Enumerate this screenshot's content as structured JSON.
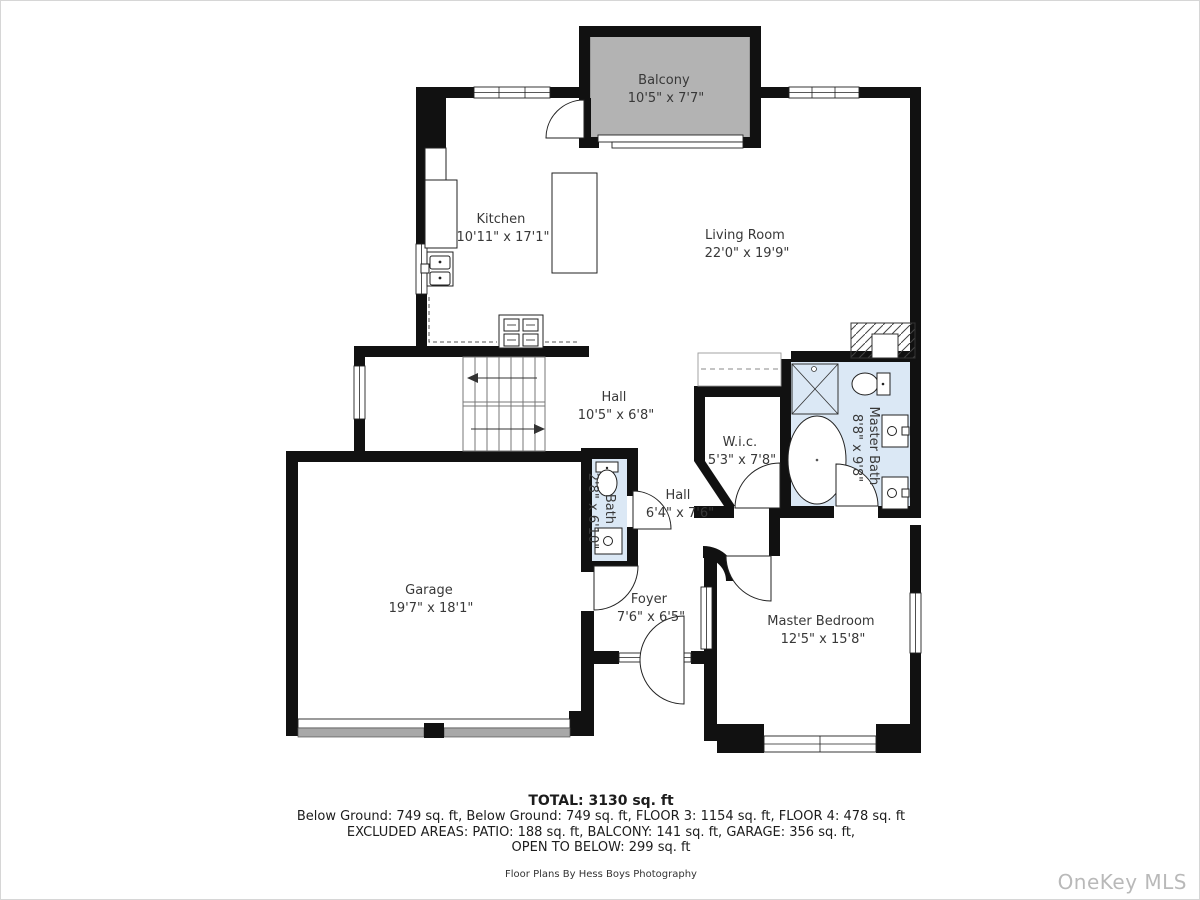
{
  "rooms": {
    "balcony": {
      "name": "Balcony",
      "dims": "10'5\" x 7'7\""
    },
    "kitchen": {
      "name": "Kitchen",
      "dims": "10'11\" x 17'1\""
    },
    "living_room": {
      "name": "Living Room",
      "dims": "22'0\" x 19'9\""
    },
    "hall_upper": {
      "name": "Hall",
      "dims": "10'5\" x 6'8\""
    },
    "wic": {
      "name": "W.i.c.",
      "dims": "5'3\" x 7'8\""
    },
    "master_bath": {
      "name": "Master Bath",
      "dims": "8'8\" x 9'8\""
    },
    "bath": {
      "name": "Bath",
      "dims": "2'8\" x 6'10\""
    },
    "hall_lower": {
      "name": "Hall",
      "dims": "6'4\" x 7'6\""
    },
    "garage": {
      "name": "Garage",
      "dims": "19'7\" x 18'1\""
    },
    "foyer": {
      "name": "Foyer",
      "dims": "7'6\" x 6'5\""
    },
    "master_bedroom": {
      "name": "Master Bedroom",
      "dims": "12'5\" x 15'8\""
    }
  },
  "footer": {
    "total": "TOTAL: 3130 sq. ft",
    "line1": "Below Ground: 749 sq. ft, Below Ground: 749 sq. ft, FLOOR 3: 1154 sq. ft, FLOOR 4: 478 sq. ft",
    "line2": "EXCLUDED AREAS: PATIO: 188 sq. ft, BALCONY: 141 sq. ft, GARAGE: 356 sq. ft,",
    "line3": "OPEN TO BELOW: 299 sq. ft",
    "credit": "Floor Plans By Hess Boys Photography"
  },
  "watermark": "OneKey MLS",
  "colors": {
    "wall": "#111111",
    "balcony_fill": "#b3b3b3",
    "bath_fill": "#dbe8f5",
    "garage_door": "#a8a8a8",
    "label_text": "#383838",
    "watermark_text": "#b9b9b9"
  }
}
